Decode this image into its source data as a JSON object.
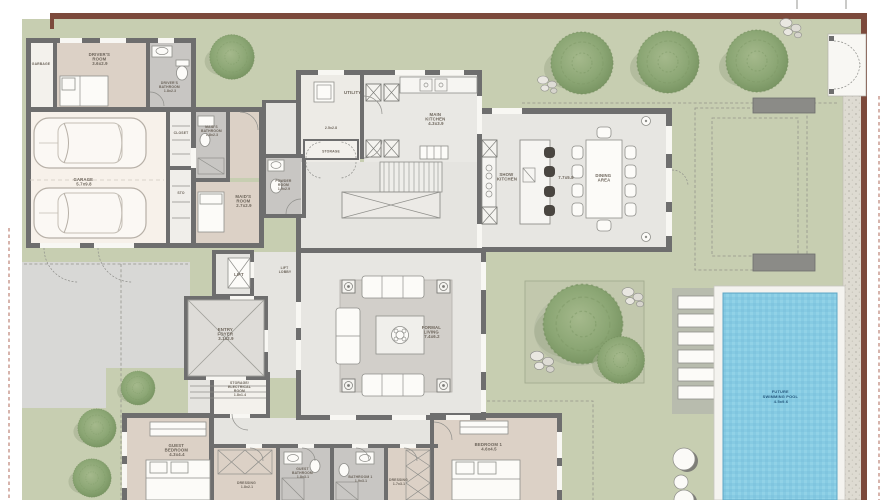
{
  "palette": {
    "boundary_wall": "#7c4a3c",
    "lawn": "#c7ceb1",
    "interior_walls": "#6e6e6e",
    "bedroom_floor": "#dcd1c6",
    "bathroom_floor": "#c8c6c3",
    "interior_floor": "#e7e6e2",
    "garage_floor": "#f7f1ea",
    "driveway": "#d8d8d6",
    "pool_water": "#86cbe3",
    "pool_deck": "#b8bcae",
    "gravel": "#dedbd2",
    "tree_green": "#8ba674"
  },
  "rooms": {
    "garbage": {
      "lines": [
        "GARBAGE"
      ]
    },
    "drivers_room": {
      "lines": [
        "DRIVER'S",
        "ROOM",
        "3.6x2.9"
      ]
    },
    "drivers_bathroom": {
      "lines": [
        "DRIVER'S",
        "BATHROOM",
        "1.8x2.3"
      ]
    },
    "closet": {
      "lines": [
        "CLOSET"
      ]
    },
    "sto": {
      "lines": [
        "STO"
      ]
    },
    "garage": {
      "lines": [
        "GARAGE",
        "5.7x9.8"
      ]
    },
    "maids_bathroom": {
      "lines": [
        "MAID'S",
        "BATHROOM",
        "1.8x2.3"
      ]
    },
    "maids_room": {
      "lines": [
        "MAID'S",
        "ROOM",
        "2.7x2.9"
      ]
    },
    "utility": {
      "lines": [
        "UTILITY",
        "2.5x2.8"
      ]
    },
    "storage": {
      "lines": [
        "STORAGE"
      ]
    },
    "main_kitchen": {
      "lines": [
        "MAIN",
        "KITCHEN",
        "4.3x3.9"
      ]
    },
    "powder_room": {
      "lines": [
        "POWDER",
        "ROOM",
        "1.9x2.9"
      ]
    },
    "show_kitchen": {
      "lines": [
        "SHOW",
        "KITCHEN"
      ]
    },
    "dining_area": {
      "lines": [
        "DINING",
        "AREA"
      ],
      "dims": "7.7x5.8"
    },
    "lift": {
      "lines": [
        "LIFT"
      ]
    },
    "lift_lobby": {
      "lines": [
        "LIFT",
        "LOBBY"
      ]
    },
    "entry_foyer": {
      "lines": [
        "ENTRY",
        "FOYER",
        "3.1x2.9"
      ]
    },
    "formal_living": {
      "lines": [
        "FORMAL",
        "LIVING",
        "7.4x6.2"
      ]
    },
    "storage_electrical": {
      "lines": [
        "STORAGE/",
        "ELECTRICAL",
        "ROOM",
        "1.8x1.4"
      ]
    },
    "guest_bedroom": {
      "lines": [
        "GUEST",
        "BEDROOM",
        "4.3x4.4"
      ]
    },
    "dressing_guest": {
      "lines": [
        "DRESSING",
        "1.8x2.1"
      ]
    },
    "guest_bathroom": {
      "lines": [
        "GUEST",
        "BATHROOM",
        "1.8x3.1"
      ]
    },
    "bathroom_1": {
      "lines": [
        "BATHROOM 1",
        "1.9x3.1"
      ]
    },
    "dressing_master": {
      "lines": [
        "DRESSING",
        "1.7x3.1"
      ]
    },
    "bedroom_1": {
      "lines": [
        "BEDROOM 1",
        "4.6x4.5"
      ]
    },
    "future_swimming_pool": {
      "lines": [
        "FUTURE",
        "SWIMMING POOL",
        "4.5x9.6"
      ]
    }
  }
}
